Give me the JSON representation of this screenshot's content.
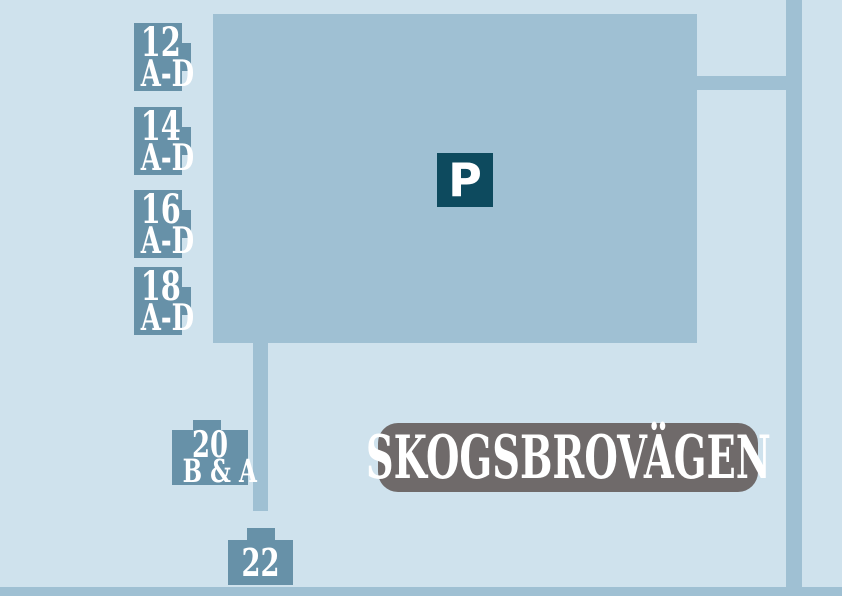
{
  "map": {
    "street_label": "SKOGSBROVÄGEN",
    "parking_symbol": "P",
    "markers": [
      {
        "number": "12",
        "letters": "A-D"
      },
      {
        "number": "14",
        "letters": "A-D"
      },
      {
        "number": "16",
        "letters": "A-D"
      },
      {
        "number": "18",
        "letters": "A-D"
      },
      {
        "number": "20",
        "letters": "B & A"
      },
      {
        "number": "22",
        "letters": ""
      }
    ],
    "colors": {
      "background": "#cfe2ed",
      "road": "#9fc0d3",
      "marker": "#6791a8",
      "parking-sign": "#0d4a5e",
      "street-label-bg": "#6f6a6a",
      "label-text": "#ffffff"
    }
  }
}
